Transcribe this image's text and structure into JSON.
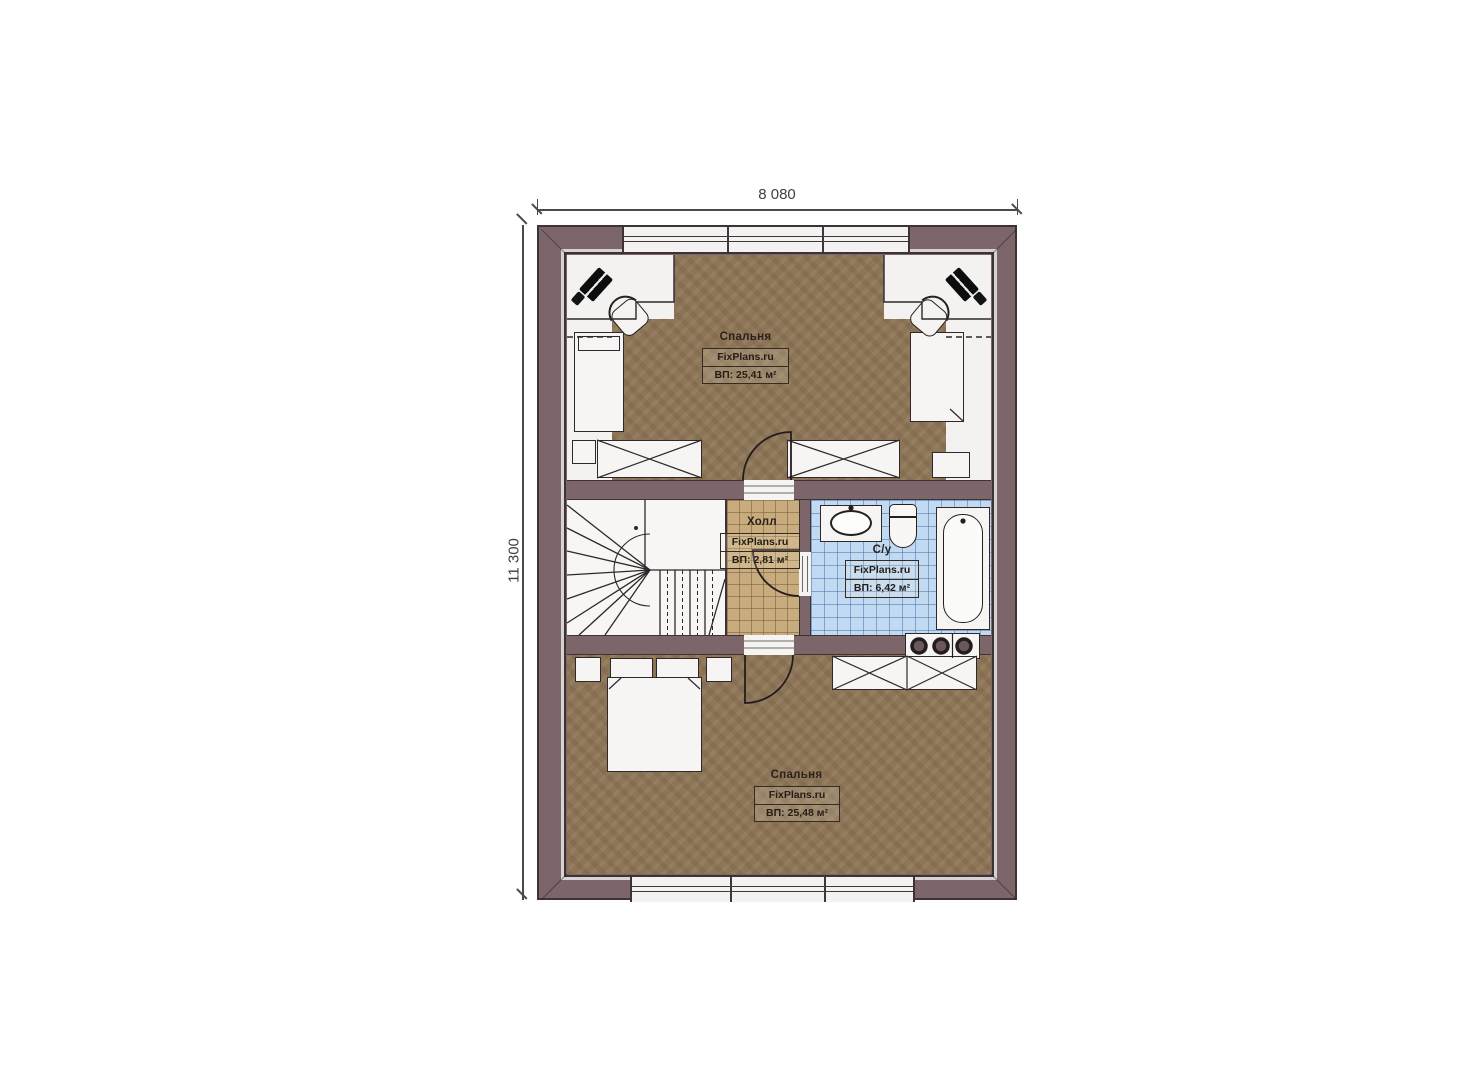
{
  "plan": {
    "dimensions": {
      "width": "8 080",
      "height": "11 300"
    },
    "rooms": {
      "bedroom_top": {
        "name": "Спальня",
        "brand": "FixPlans.ru",
        "area": "ВП: 25,41 м²"
      },
      "hall": {
        "name": "Холл",
        "brand": "FixPlans.ru",
        "area": "ВП: 2,81 м²"
      },
      "bathroom": {
        "name": "С/у",
        "brand": "FixPlans.ru",
        "area": "ВП: 6,42 м²"
      },
      "bedroom_bottom": {
        "name": "Спальня",
        "brand": "FixPlans.ru",
        "area": "ВП: 25,48 м²"
      }
    }
  },
  "colors": {
    "wall": "#7c6669",
    "wall-edge": "#d8d2d1",
    "outline": "#3b3335",
    "floor": "#8d7557",
    "hall-tile": "#c9ac7e",
    "bath-tile": "#c2daf1",
    "ink": "#2a211c",
    "dim": "#4a4a4a"
  }
}
